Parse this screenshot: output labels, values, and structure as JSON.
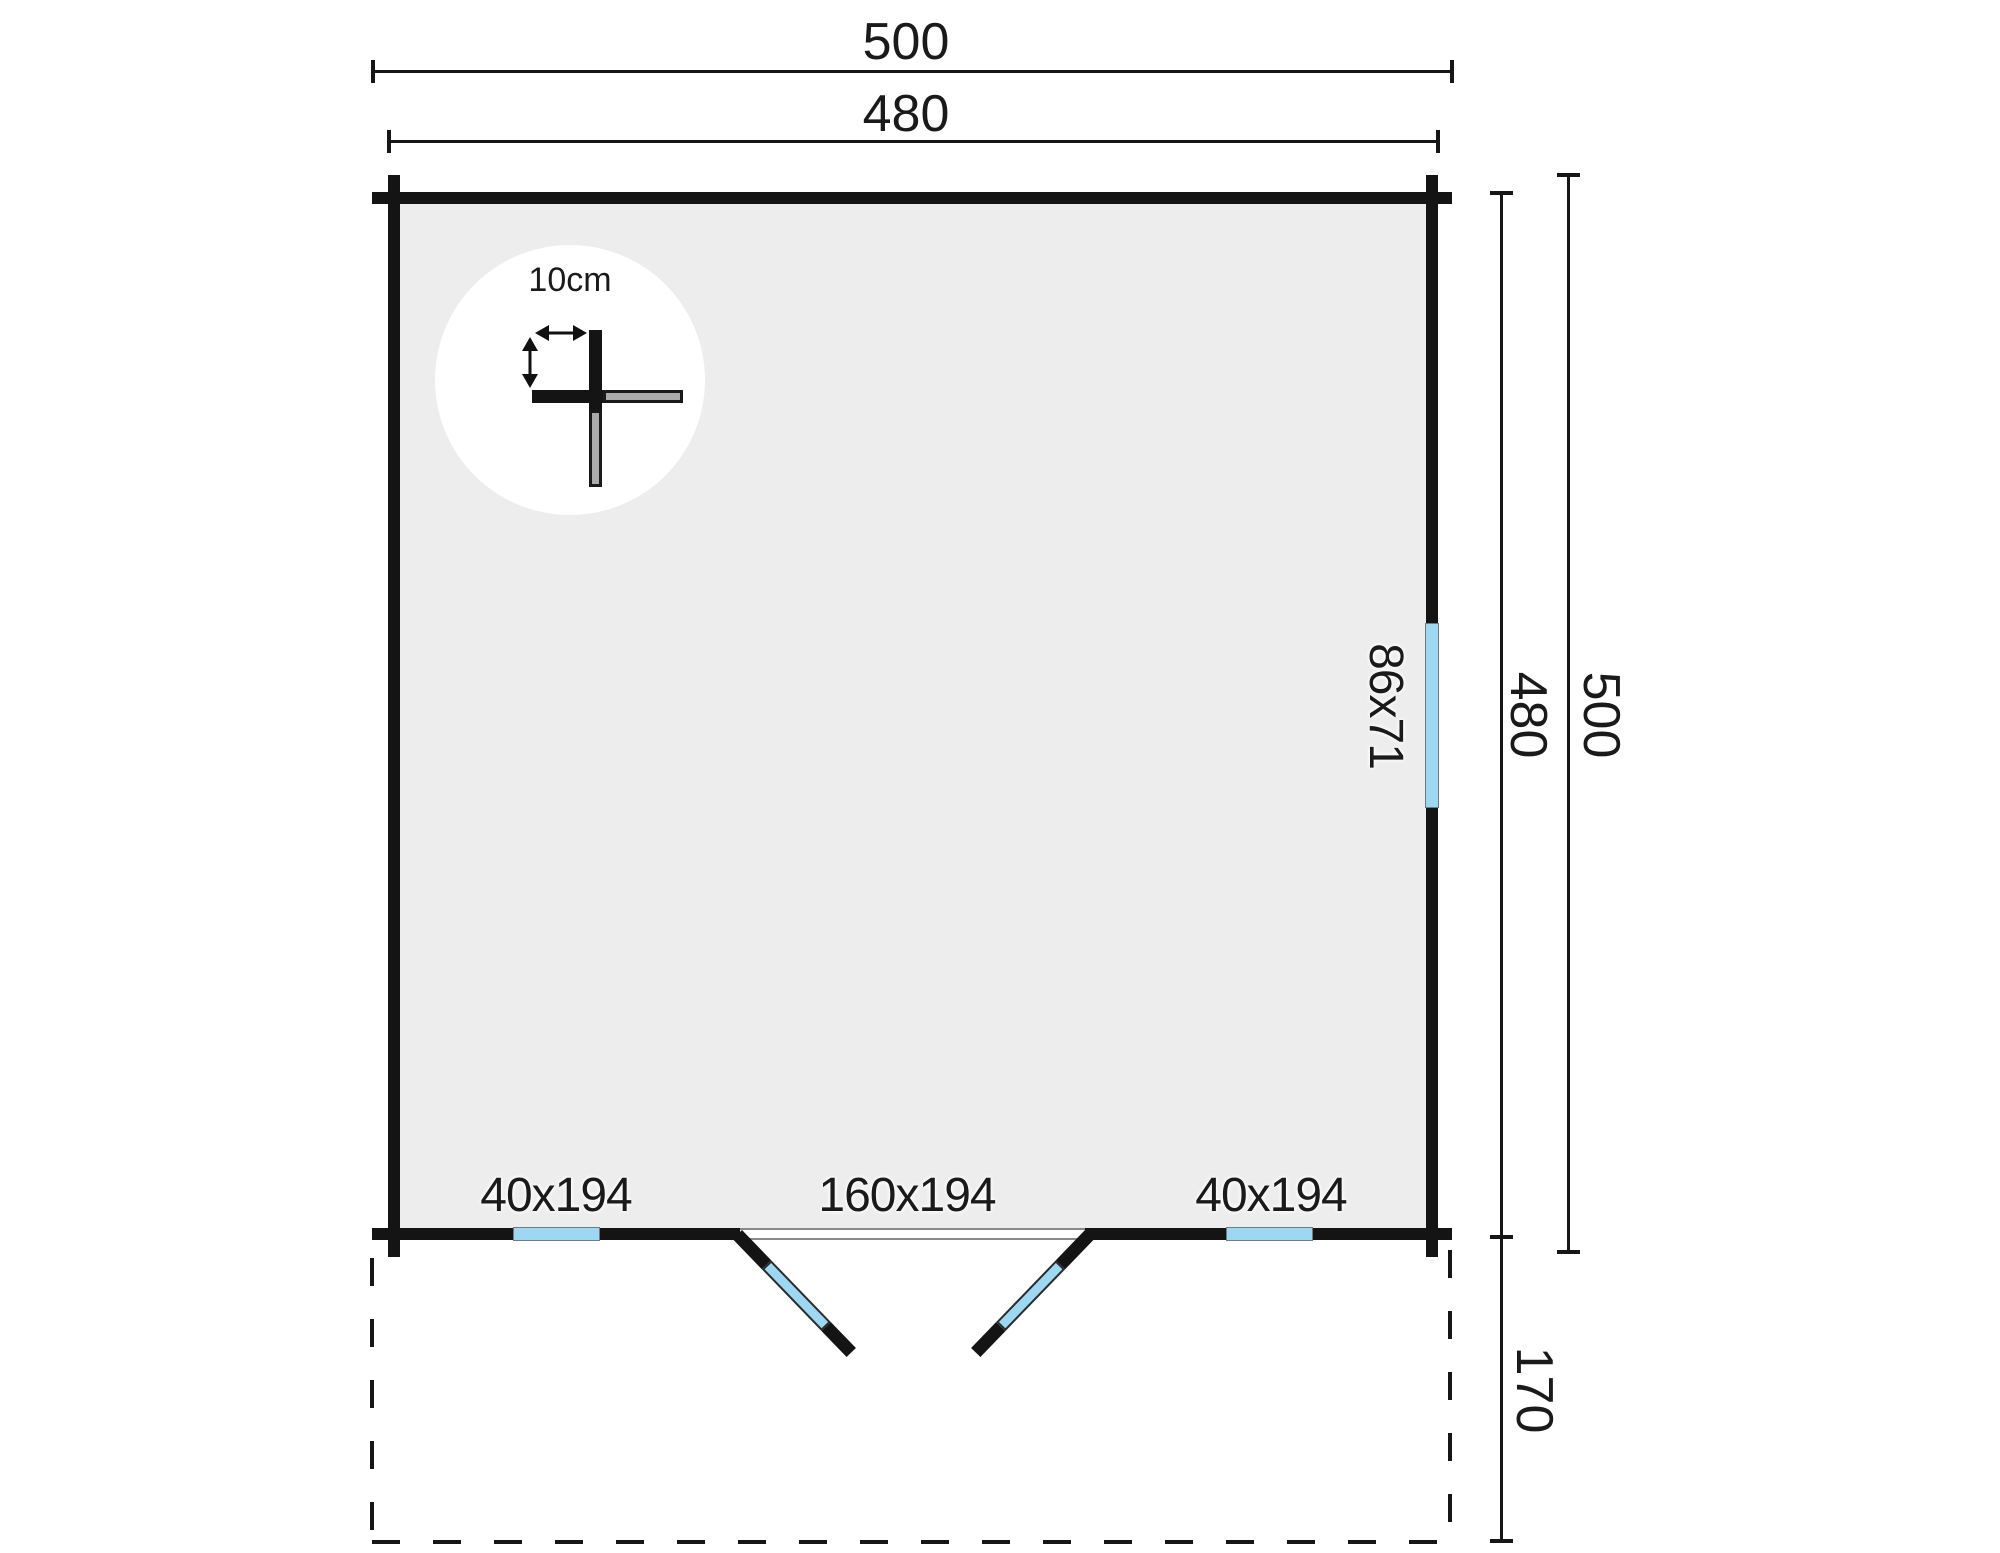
{
  "plan": {
    "type": "log-cabin-floor-plan",
    "dimensions": {
      "top_overall": "500",
      "top_inner": "480",
      "right_inner": "480",
      "right_overall": "500",
      "terrace_depth": "170"
    },
    "openings": {
      "side_window": "86x71",
      "left_window": "40x194",
      "double_door": "160x194",
      "right_window": "40x194"
    },
    "detail": {
      "wall_thickness": "10cm"
    },
    "colors": {
      "wall_black": "#141414",
      "glass_blue": "#9ed7f2",
      "interior_gray": "#ededee",
      "log_gray": "#ababab",
      "background": "#ffffff"
    }
  }
}
